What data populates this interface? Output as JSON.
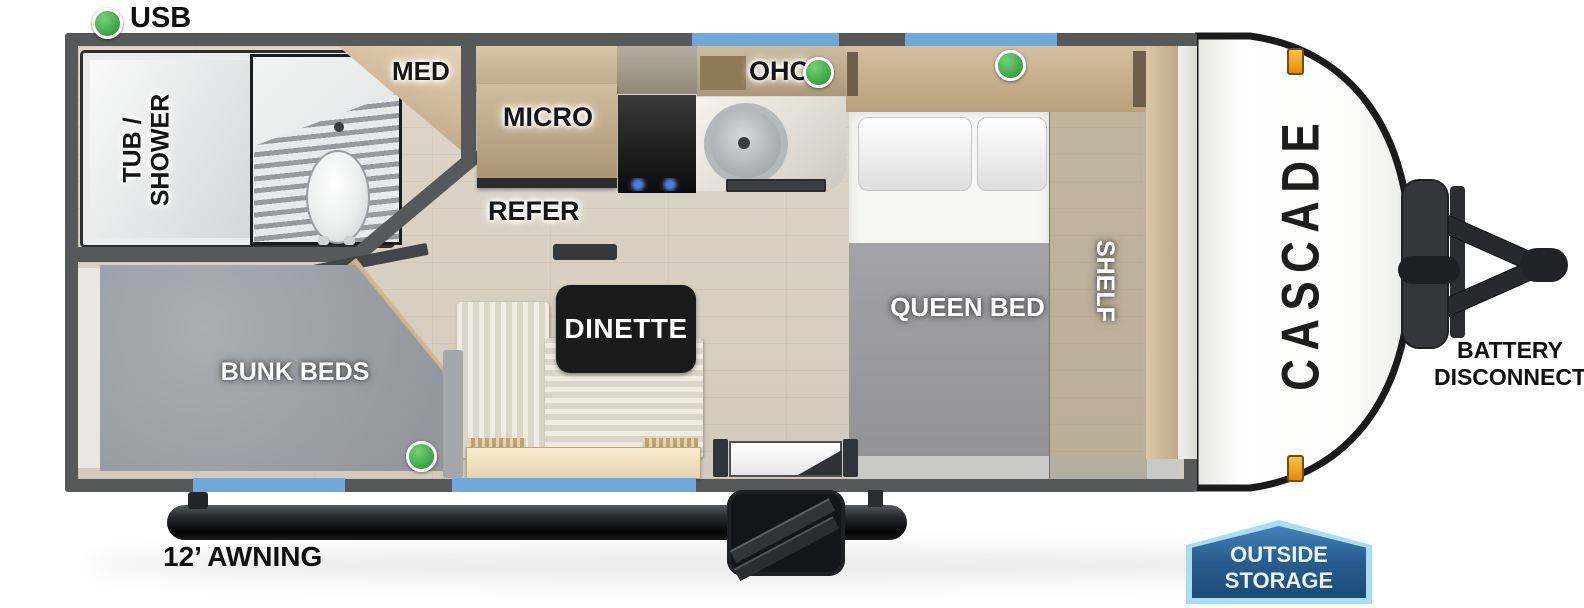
{
  "legend": {
    "usb": "USB"
  },
  "labels": {
    "tub_line1": "TUB /",
    "tub_line2": "SHOWER",
    "med": "MED",
    "micro": "MICRO",
    "refer": "REFER",
    "ohc": "OHC",
    "queen_bed": "QUEEN BED",
    "shelf": "SHELF",
    "bunk_beds": "BUNK BEDS",
    "dinette": "DINETTE"
  },
  "exterior": {
    "brand": "CASCADE",
    "awning": "12’ AWNING",
    "battery_line1": "BATTERY",
    "battery_line2": "DISCONNECT",
    "storage_line1": "OUTSIDE",
    "storage_line2": "STORAGE"
  },
  "colors": {
    "wall": "#57585A",
    "window": "#6FA9DA",
    "usb_indicator": "#3AA344",
    "floor": "#D8D0C3",
    "bunk_mattress": "#A0A2A9",
    "storage_badge_fill": "#1C4A77",
    "storage_badge_border": "#A9DDF1",
    "marker_light": "#F7A01D",
    "awning_tube": "#1A1C1E"
  }
}
